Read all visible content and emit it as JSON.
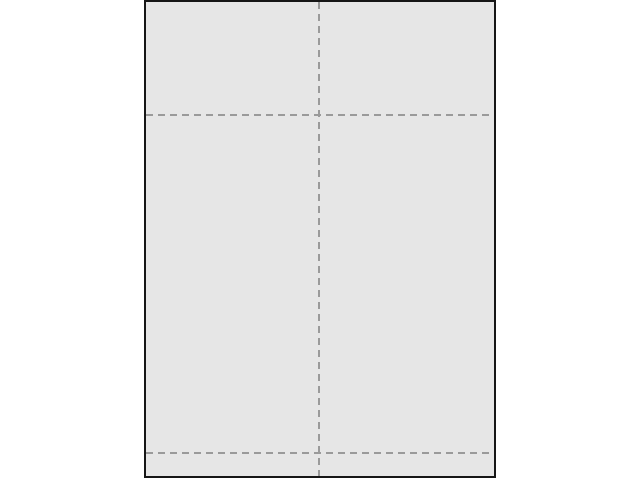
{
  "workspace": {
    "background_color": "#ffffff"
  },
  "page": {
    "fill_color": "#e6e6e6",
    "border_color": "#161616",
    "border_width": 2,
    "left": 144,
    "top": 0,
    "width": 352,
    "height": 478
  },
  "guides": {
    "style": "dashed",
    "color": "#9a9a9a",
    "dash_length": 7,
    "gap_length": 5,
    "thickness": 2,
    "items": [
      {
        "id": "center-vertical-fold",
        "axis": "vertical",
        "x": 319
      },
      {
        "id": "upper-horizontal-fold",
        "axis": "horizontal",
        "y": 115
      },
      {
        "id": "lower-horizontal-fold",
        "axis": "horizontal",
        "y": 453
      }
    ]
  }
}
